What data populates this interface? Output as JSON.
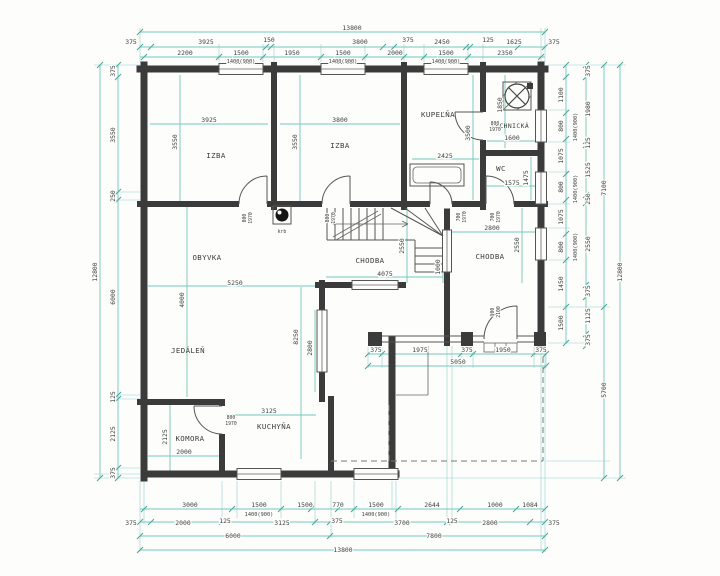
{
  "colors": {
    "dimension": "#74c7bb",
    "wall": "#3b3b3b",
    "background": "#fdfdfc"
  },
  "rooms": {
    "izba1": "IZBA",
    "izba2": "IZBA",
    "kupelna": "KUPEĽŇA",
    "technicka": "TECHNICKÁ",
    "wc": "WC",
    "obyvka": "OBYVKA",
    "chodba1": "CHODBA",
    "chodba2": "CHODBA",
    "jedalen": "JEDÁLEŇ",
    "komora": "KOMORA",
    "kuchyna": "KUCHYŇA",
    "krb": "krb"
  },
  "dims": {
    "top": {
      "overall": "13800",
      "corner_l": "375",
      "corner_r": "375",
      "row1": [
        "3925",
        "150",
        "3800",
        "375",
        "2450",
        "125",
        "1625"
      ],
      "row2": [
        "2200",
        "1500",
        "1950",
        "1500",
        "2000",
        "1500",
        "2350"
      ],
      "windows": [
        "1400(900)",
        "1400(900)",
        "1400(900)"
      ]
    },
    "bottom": {
      "row1": [
        "3000",
        "1500",
        "1500",
        "770",
        "1500",
        "2644",
        "1000",
        "1084"
      ],
      "windows": [
        "1400(900)",
        "1400(900)"
      ],
      "row2": [
        "375",
        "2000",
        "125",
        "3125",
        "375",
        "3700",
        "125",
        "2800",
        "375"
      ],
      "row3": [
        "6000",
        "7800"
      ],
      "overall": "13800"
    },
    "left": {
      "col1": [
        "375",
        "3550",
        "250",
        "6000",
        "125",
        "2125",
        "375"
      ],
      "overall": "12800"
    },
    "right": {
      "col1": [
        "1100",
        "800",
        "1075",
        "800",
        "1075",
        "800",
        "1450",
        "1500"
      ],
      "windows": [
        "1400(900)",
        "1400(900)",
        "1400(900)"
      ],
      "col2": [
        "375",
        "1980",
        "125",
        "1525",
        "250",
        "2550",
        "375",
        "1125",
        "375"
      ],
      "col3": [
        "7100",
        "5700"
      ],
      "overall": "12800"
    },
    "interior": {
      "izba1_w": "3925",
      "izba1_h": "3550",
      "izba2_w": "3800",
      "izba2_h": "3550",
      "kupelna_w": "2425",
      "kupelna_h": "3500",
      "technicka_w": "1600",
      "technicka_h": "1850",
      "wc_w": "1575",
      "wc_h": "1475",
      "obyvka_w": "5250",
      "obyvka_h": "4000",
      "chodba1_w": "4075",
      "chodba1_h": "2550",
      "chodba1_n": "1000",
      "chodba2_w": "2800",
      "chodba2_h": "2550",
      "jedalen_v1": "8250",
      "jedalen_v2": "2800",
      "kuchyna_w": "3125",
      "komora_w": "2000",
      "komora_h": "2125",
      "porch": [
        "375",
        "1975",
        "375",
        "1950",
        "375"
      ],
      "porch_total": "5050"
    },
    "doors": {
      "w800": "800",
      "w700": "700",
      "w900": "900",
      "h1970": "1970",
      "h2100": "2100"
    }
  }
}
